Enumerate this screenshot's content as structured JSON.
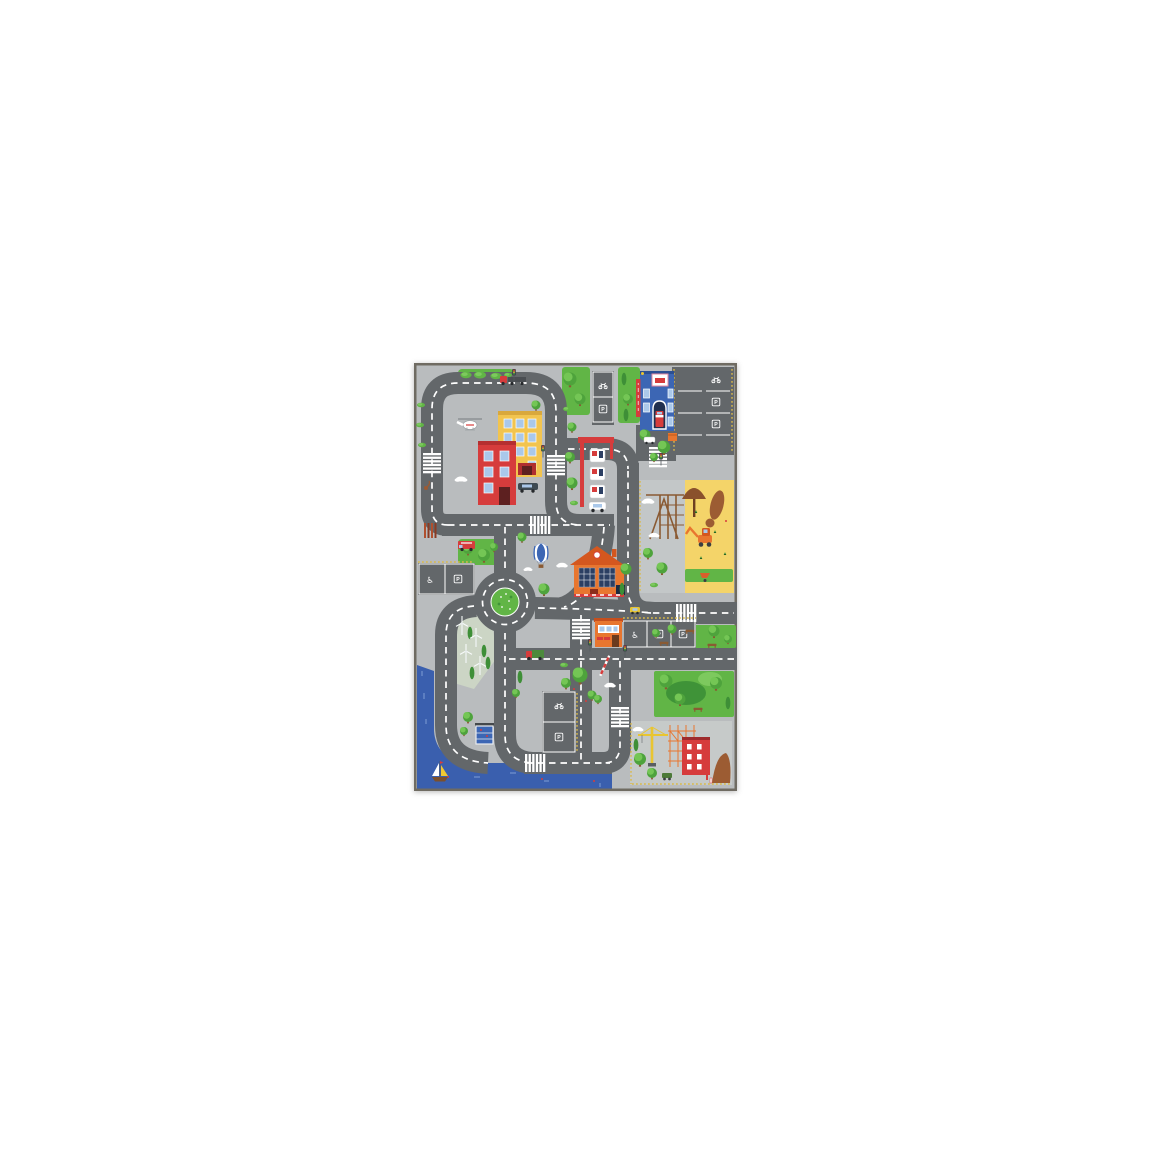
{
  "image": {
    "subject": "Children's city traffic play mat rug",
    "presentation": "product photo centered on white background"
  },
  "labels": {
    "parking": "P",
    "accessible_parking_glyph": "♿"
  },
  "colors": {
    "border": "#6f6b62",
    "sidewalk": "#b9bcbe",
    "road": "#63676a",
    "line": "#ffffff",
    "grass": "#61b546",
    "grass_light": "#7dc95e",
    "grass_dark": "#3f9338",
    "tree": "#4ea33c",
    "tree_light": "#74c655",
    "cypress": "#3e8f37",
    "river": "#3a5fae",
    "river_light": "#7e9cd4",
    "sand": "#f4d469",
    "red": "#d63c3c",
    "yellow_building": "#f2c44f",
    "blue_building": "#3c66b4",
    "orange": "#e8762f",
    "orange_dark": "#d4571f",
    "roof": "#42464b",
    "window": "#aac8ea",
    "solar": "#2c3f63",
    "wood": "#8a5a33",
    "dirt": "#9c5c33",
    "crane": "#e9c531",
    "tactile": "#d9b94a",
    "wind_area": "#ccd5c5",
    "construction_ground": "#c6cac9"
  },
  "features": [
    "fire-station",
    "city-apartment-buildings",
    "gas-station",
    "school-with-solar-panels",
    "street-kiosk",
    "newsstand-shelter",
    "playground-sandbox-with-excavator",
    "construction-site-with-crane",
    "roundabout",
    "river-with-sailboat",
    "wind-turbines",
    "hot-air-balloon",
    "helicopter",
    "parking-lots",
    "crosswalks",
    "traffic-lights",
    "parks-and-trees"
  ]
}
